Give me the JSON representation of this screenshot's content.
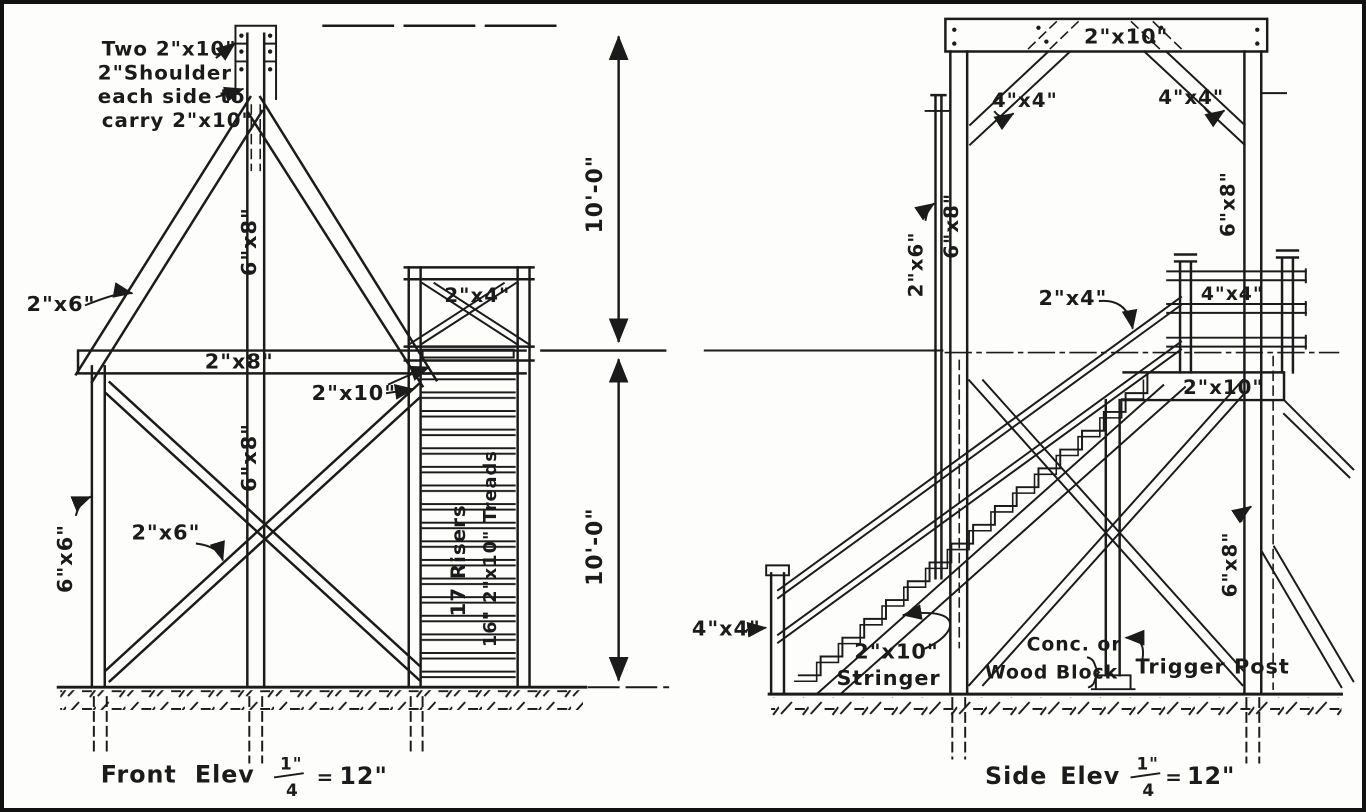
{
  "front_elevation": {
    "caption": {
      "word1": "Front",
      "word2": "Elev"
    },
    "note": [
      "Two 2\"x10\"",
      "2\"Shoulder",
      "each side to",
      "carry 2\"x10\""
    ],
    "labels": {
      "aframe_brace": "2\"x6\"",
      "pole_upper": "6\"x8\"",
      "beam": "2\"x8\"",
      "stair_carriage": "2\"x10\"",
      "pole_lower": "6\"x8\"",
      "x_brace": "2\"x6\"",
      "left_post": "6\"x6\"",
      "guard_rail": "2\"x4\"",
      "risers": "17 Risers",
      "treads": "16\" 2\"x10\" Treads"
    }
  },
  "dimensions": {
    "upper_height": "10'-0\"",
    "lower_height": "10'-0\""
  },
  "side_elevation": {
    "caption": {
      "word1": "Side",
      "word2": "Elev"
    },
    "labels": {
      "top_beam": "2\"x10\"",
      "knee_brace_left": "4\"x4\"",
      "knee_brace_right": "4\"x4\"",
      "outer_post": "2\"x6\"",
      "left_post": "6\"x8\"",
      "right_post_upper": "6\"x8\"",
      "stair_rail": "2\"x4\"",
      "platform_rail_post": "4\"x4\"",
      "platform_beam": "2\"x10\"",
      "newel_post": "4\"x4\"",
      "stringer_size": "2\"x10\"",
      "stringer_name": "Stringer",
      "footing_line1": "Conc. or",
      "footing_line2": "Wood Block",
      "trigger_post": "Trigger Post",
      "right_post_lower": "6\"x8\""
    }
  },
  "scale": {
    "numerator": "1\"",
    "denominator": "4",
    "equals": "=",
    "value": "12\""
  }
}
